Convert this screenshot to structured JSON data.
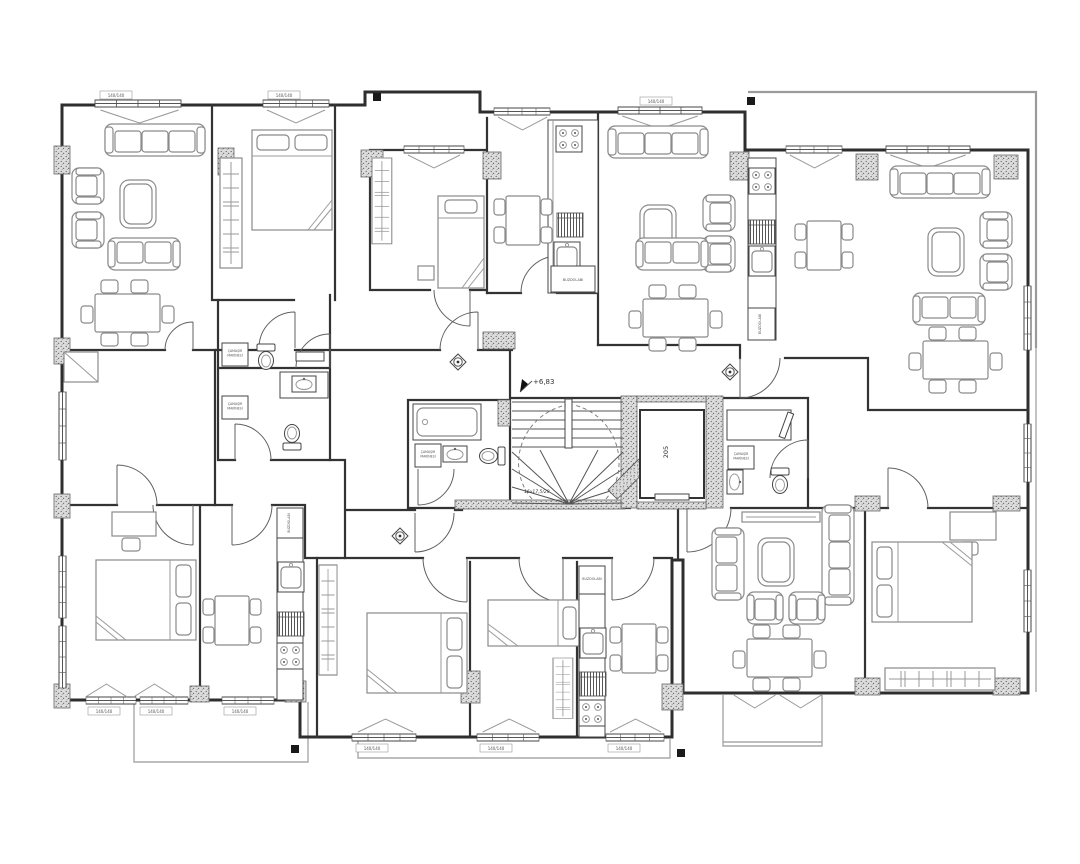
{
  "document": {
    "type": "apartment building floor plan",
    "floor_level": "+6,83"
  },
  "labels": {
    "level_mark": "+6,83",
    "elevator_room": "205",
    "fridge": "BUZDOLABI",
    "washer_line1": "ÇAMAŞIR",
    "washer_line2": "MAKİNESİ",
    "stair_note": "16x17,5/28",
    "window_tag": "140/140"
  }
}
